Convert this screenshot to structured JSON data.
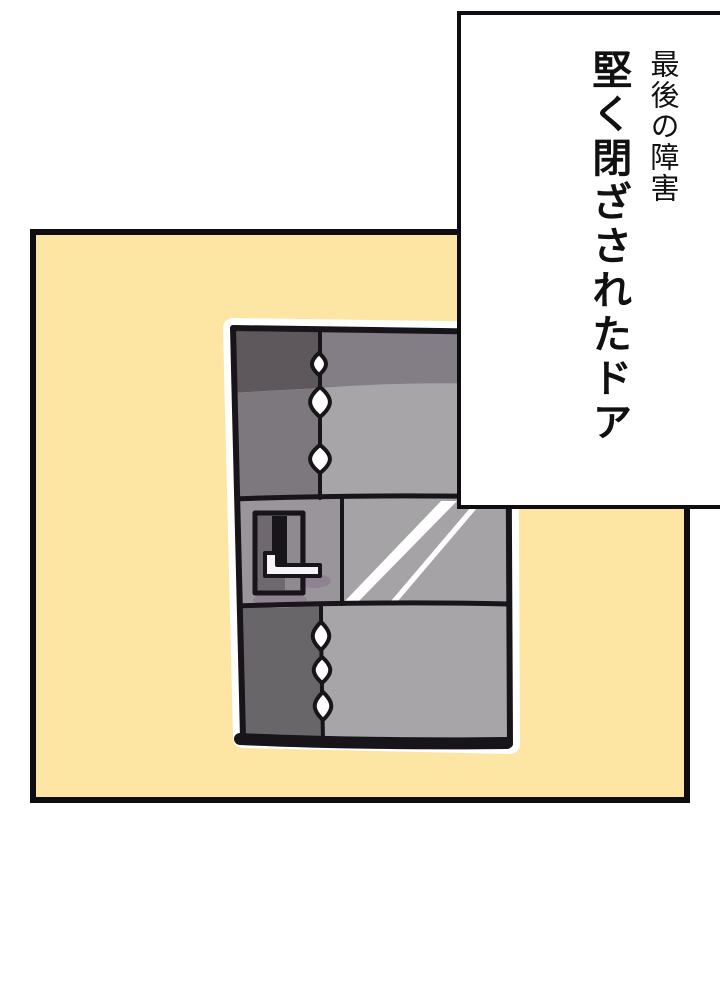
{
  "panel": {
    "background": "#fde5a3",
    "border_color": "#0f0d11"
  },
  "narration_box": {
    "line1": "最後の障害",
    "line2": "堅く閉ざされたドア"
  },
  "illustration": {
    "subject": "closed-metal-door",
    "colors": {
      "outline": "#17141a",
      "halo": "#ffffff",
      "band_left": "#5e575c",
      "band_right": "#837d85",
      "upper_left": "#7d787d",
      "upper_right": "#a7a5a7",
      "mid_left": "#9a959b",
      "mid_right": "#a5a3a5",
      "bottom_left": "#696669",
      "plate": "#6f686e",
      "plate_light": "#8f8a8f",
      "slot": "#17141a",
      "handle": "#f5f3f5",
      "shadow": "#8e8090",
      "rivet": "#ffffff",
      "streak": "#ffffff"
    }
  }
}
